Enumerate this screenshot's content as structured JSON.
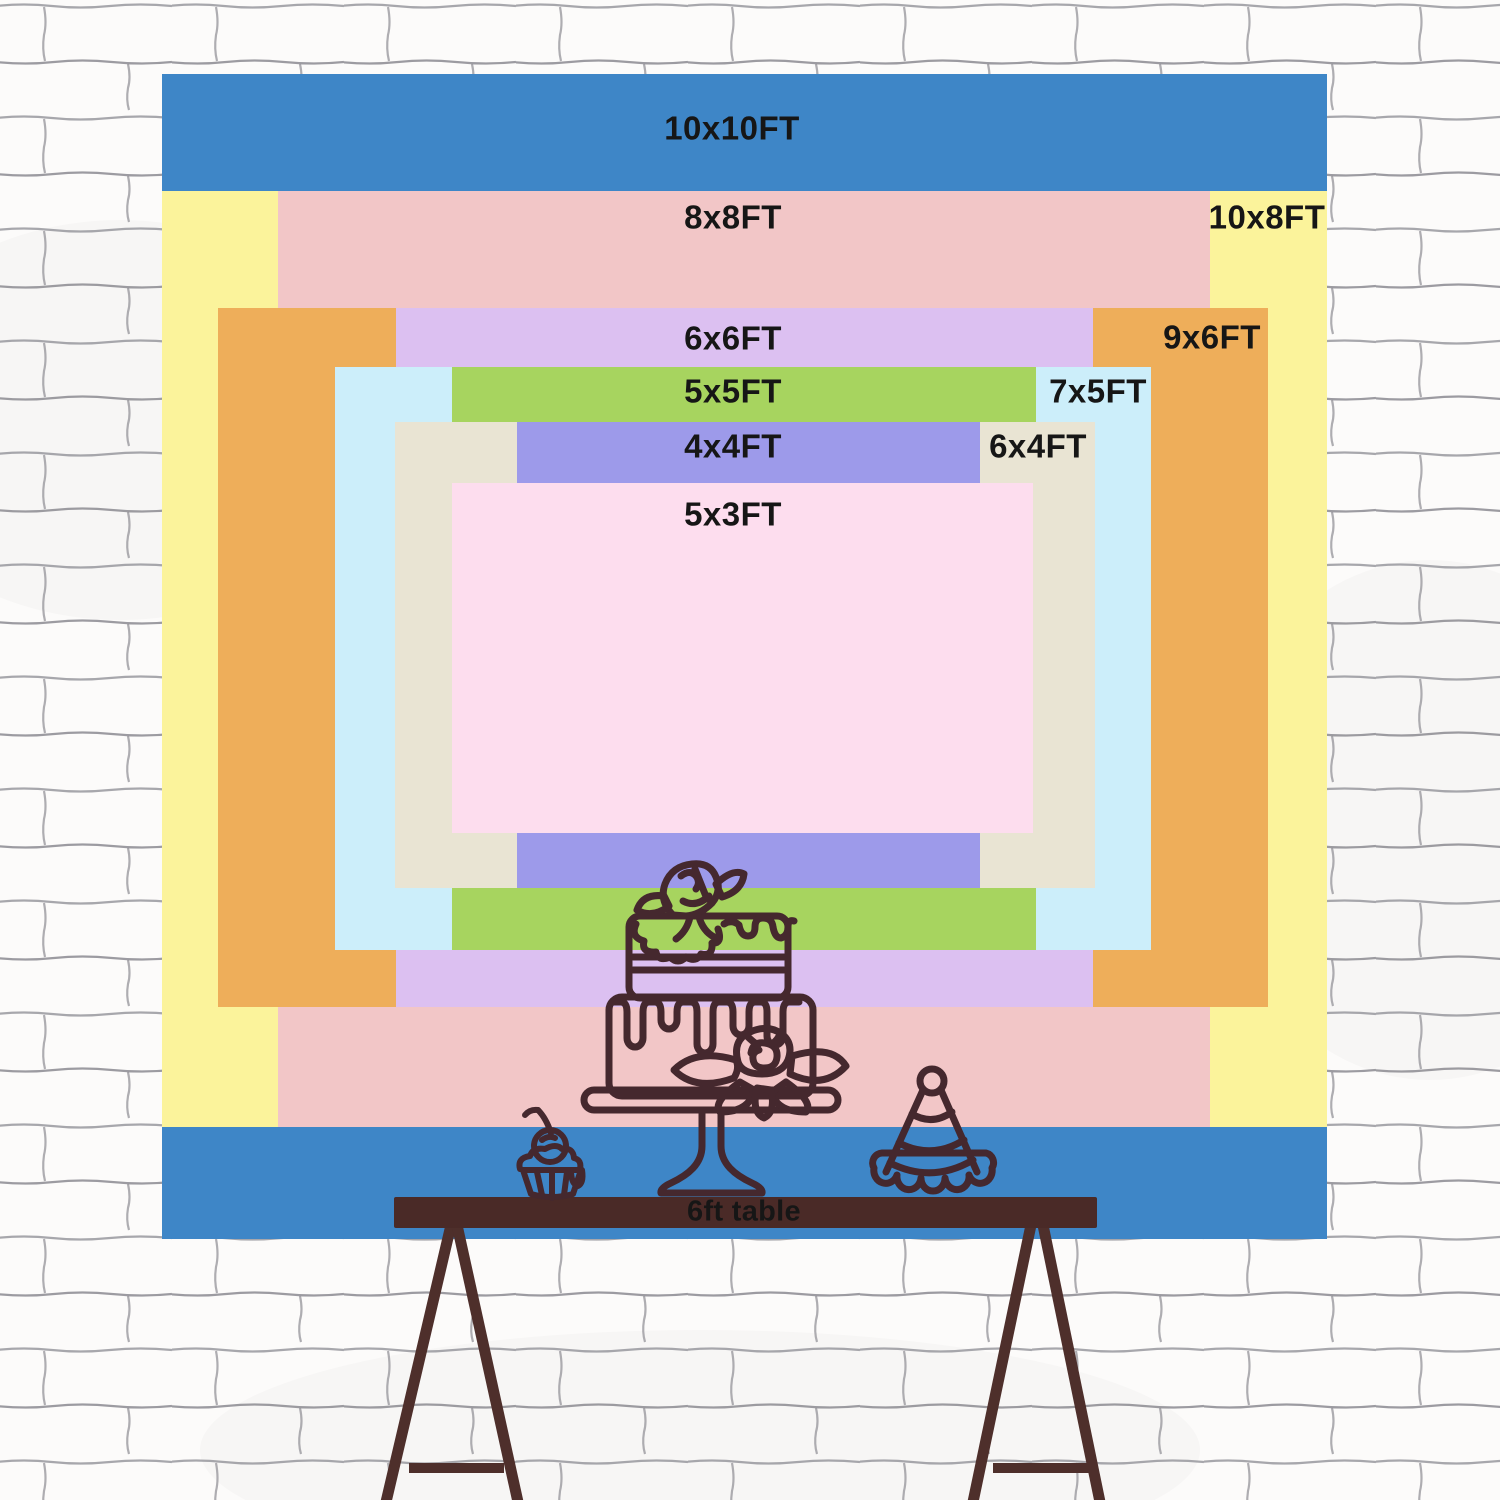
{
  "backdrop": {
    "description": "backdrop size comparison chart",
    "label_color": "#161616",
    "sizes": [
      {
        "label": "10x10FT",
        "width_ft": 10,
        "height_ft": 10,
        "color": "#3e86c7"
      },
      {
        "label": "10x8FT",
        "width_ft": 10,
        "height_ft": 8,
        "color": "#fbf39b"
      },
      {
        "label": "8x8FT",
        "width_ft": 8,
        "height_ft": 8,
        "color": "#f2c6c7"
      },
      {
        "label": "9x6FT",
        "width_ft": 9,
        "height_ft": 6,
        "color": "#eeae5a"
      },
      {
        "label": "6x6FT",
        "width_ft": 6,
        "height_ft": 6,
        "color": "#dcc0f1"
      },
      {
        "label": "7x5FT",
        "width_ft": 7,
        "height_ft": 5,
        "color": "#cceefa"
      },
      {
        "label": "5x5FT",
        "width_ft": 5,
        "height_ft": 5,
        "color": "#a7d45f"
      },
      {
        "label": "6x4FT",
        "width_ft": 6,
        "height_ft": 4,
        "color": "#e9e4d3"
      },
      {
        "label": "4x4FT",
        "width_ft": 4,
        "height_ft": 4,
        "color": "#9d9aea"
      },
      {
        "label": "5x3FT",
        "width_ft": 5,
        "height_ft": 3,
        "color": "#fdddee"
      }
    ]
  },
  "table": {
    "label": "6ft table",
    "top_color": "#4a2a27",
    "leg_color": "#4e2f2b"
  },
  "illustration": {
    "line_color": "#45282e",
    "items": [
      "tiered-cake-on-stand",
      "cupcake-with-cherry",
      "party-hat"
    ]
  },
  "wall": {
    "style": "white sketched brick",
    "base_color": "#fcfbfa",
    "line_color": "#84838b"
  }
}
